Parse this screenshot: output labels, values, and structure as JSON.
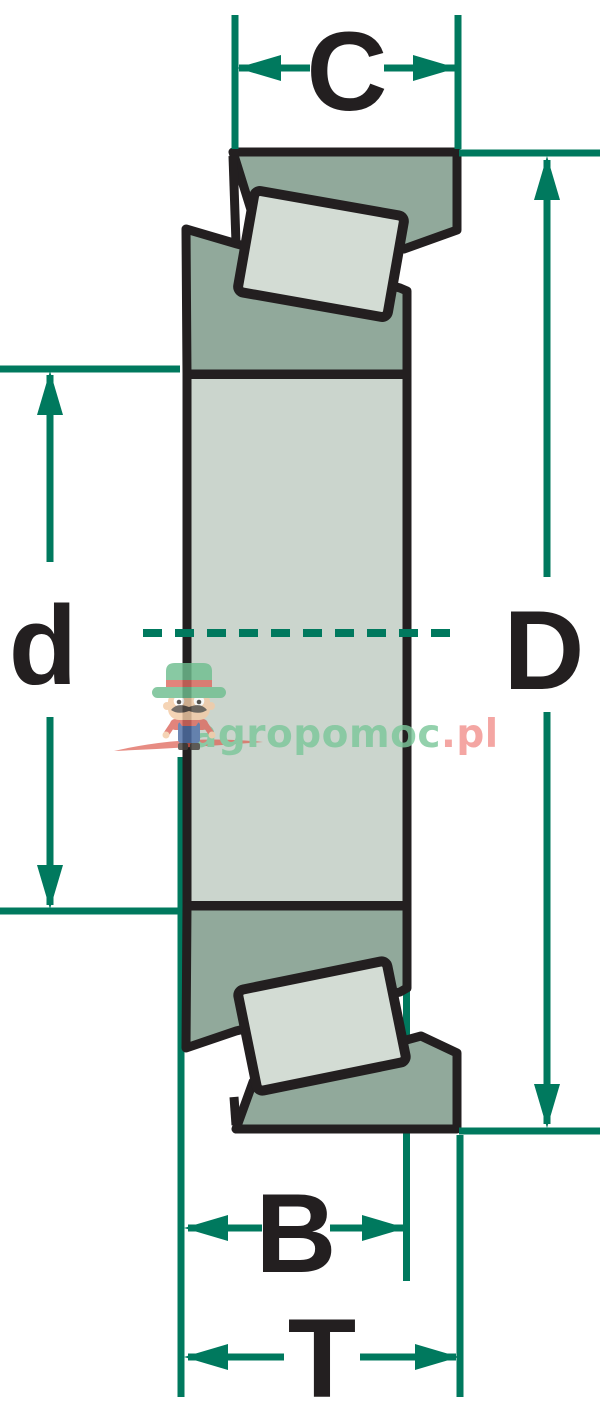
{
  "diagram": {
    "labels": {
      "C": "C",
      "D": "D",
      "d": "d",
      "B": "B",
      "T": "T"
    },
    "colors": {
      "dimension_line": "#00795E",
      "outline": "#231F20",
      "ring_fill": "#91A99B",
      "body_fill": "#CBD5CD",
      "roller_fill": "#D3DCD4",
      "watermark_green": "#7CC79B",
      "watermark_pink": "#F2938F",
      "watermark_red": "#DC5A4E"
    }
  },
  "watermark": {
    "brand_green": "agropomoc",
    "brand_pink": ".pl"
  }
}
